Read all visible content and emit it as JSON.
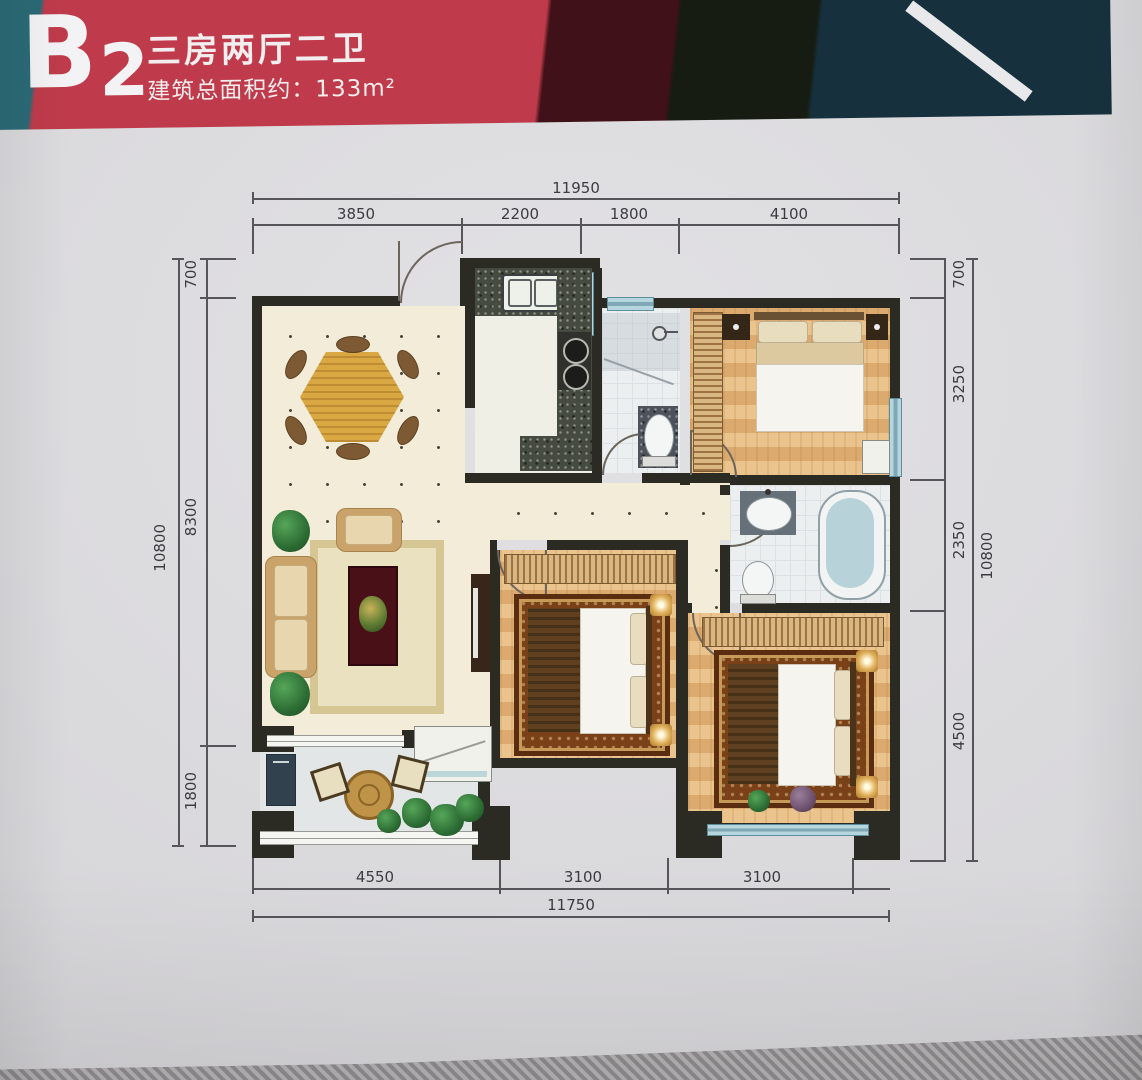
{
  "header": {
    "unit_b": "B",
    "unit_num": "2",
    "title": "三房两厅二卫",
    "area_label": "建筑总面积约：133m²",
    "colors": {
      "teal": "#2a6a75",
      "red": "#bf3b4b",
      "maroon": "#401118",
      "dark_green": "#161c12",
      "dark_navy": "#16313d",
      "stripe_white": "#e9e9ec"
    }
  },
  "dimensions": {
    "top": {
      "total": "11950",
      "segments": [
        "3850",
        "2200",
        "1800",
        "4100"
      ]
    },
    "bottom": {
      "total": "11750",
      "segments": [
        "4550",
        "3100",
        "3100"
      ]
    },
    "left": {
      "total": "10800",
      "segments": [
        "700",
        "8300",
        "1800"
      ]
    },
    "right": {
      "total": "10800",
      "segments": [
        "700",
        "3250",
        "2350",
        "4500"
      ]
    }
  }
}
